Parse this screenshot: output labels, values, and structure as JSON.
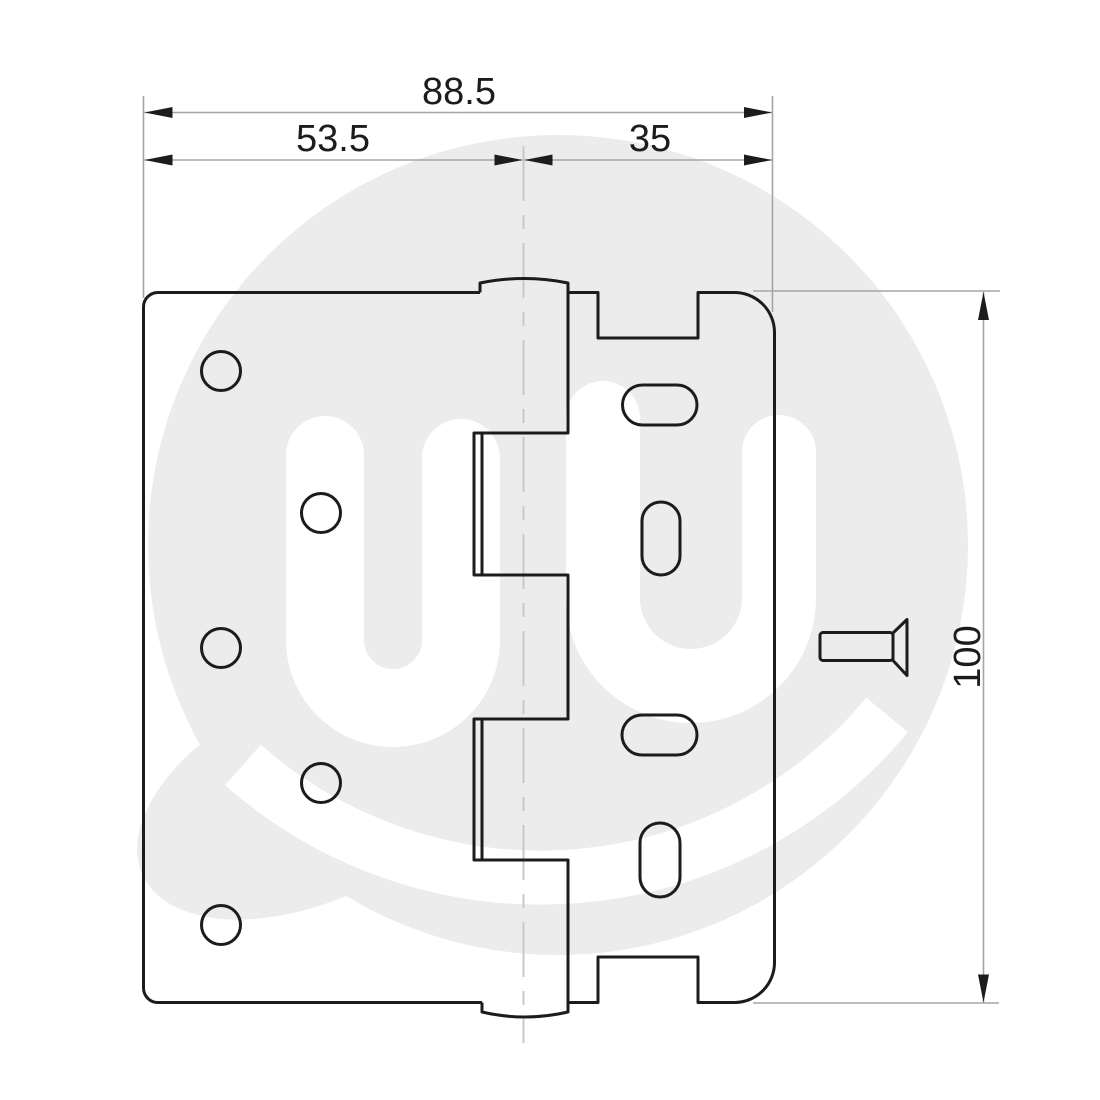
{
  "drawing": {
    "title": "hinge-dimension-drawing",
    "dimensions": {
      "overall_width": "88.5",
      "left_leaf_width": "53.5",
      "right_leaf_width": "35",
      "height": "100"
    },
    "colors": {
      "line": "#1c1c1c",
      "dimension_line": "#a5a5a5",
      "centerline": "#c9c9c9",
      "watermark": "#ececec",
      "background": "#ffffff"
    },
    "parts": {
      "left_leaf_holes": 5,
      "right_leaf_slots": 4,
      "fastener": "countersunk screw side profile"
    }
  }
}
